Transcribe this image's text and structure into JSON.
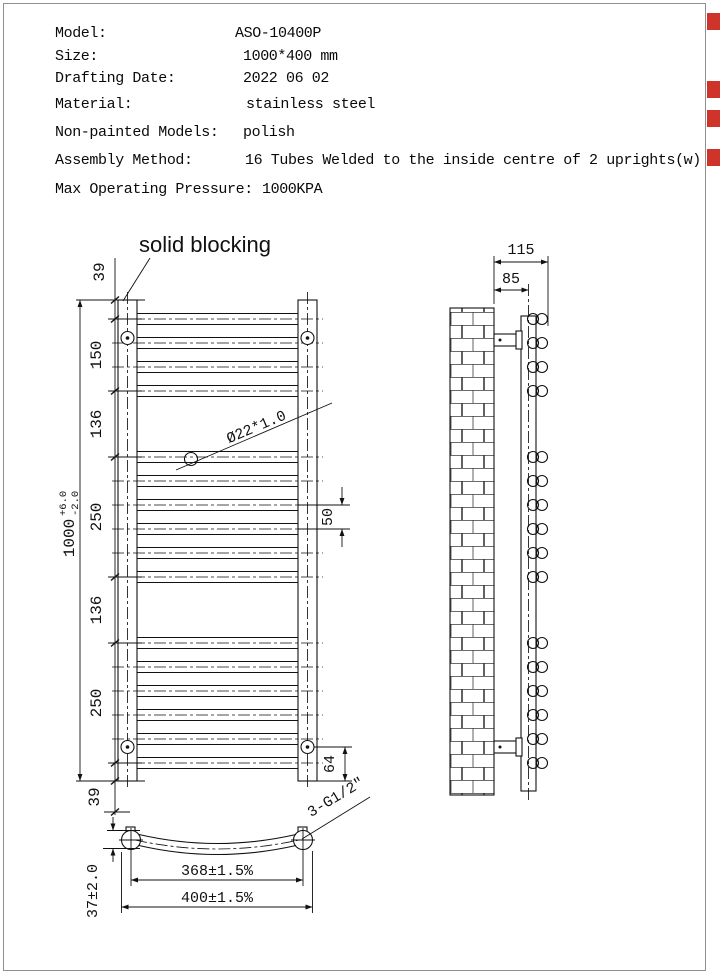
{
  "edge_markers": {
    "color": "#cf342a"
  },
  "spec_table": {
    "rows": [
      {
        "label": "Model:",
        "value": "ASO-10400P"
      },
      {
        "label": "Size:",
        "value": "1000*400 mm"
      },
      {
        "label": "Drafting Date:",
        "value": "2022 06 02"
      },
      {
        "label": "Material:",
        "value": "stainless steel"
      },
      {
        "label": "Non-painted Models:",
        "value": "polish"
      },
      {
        "label": "Assembly Method:",
        "value": "16 Tubes Welded to the inside centre of 2 uprights(w)"
      },
      {
        "label": "Max Operating Pressure:",
        "value": "1000KPA"
      }
    ]
  },
  "front_view": {
    "callout_label": "solid blocking",
    "tube_spec_label": "Ø22*1.0",
    "dim_overall": "1000",
    "dim_overall_tol_plus": "+6.0",
    "dim_overall_tol_minus": "-2.0",
    "dim_top_margin": "39",
    "dim_group1": "150",
    "dim_gap1": "136",
    "dim_group2": "250",
    "dim_gap2": "136",
    "dim_group3": "250",
    "dim_bottom_margin": "39",
    "dim_tube_pitch": "50",
    "dim_bracket_to_bottom": "64"
  },
  "side_view": {
    "dim_total_depth": "115",
    "dim_wall_to_tube_center": "85"
  },
  "plan_view": {
    "dim_tube_centers": "368±1.5%",
    "dim_overall_width": "400±1.5%",
    "dim_stand_off": "37±2.0",
    "connection_label": "3-G1/2\""
  }
}
